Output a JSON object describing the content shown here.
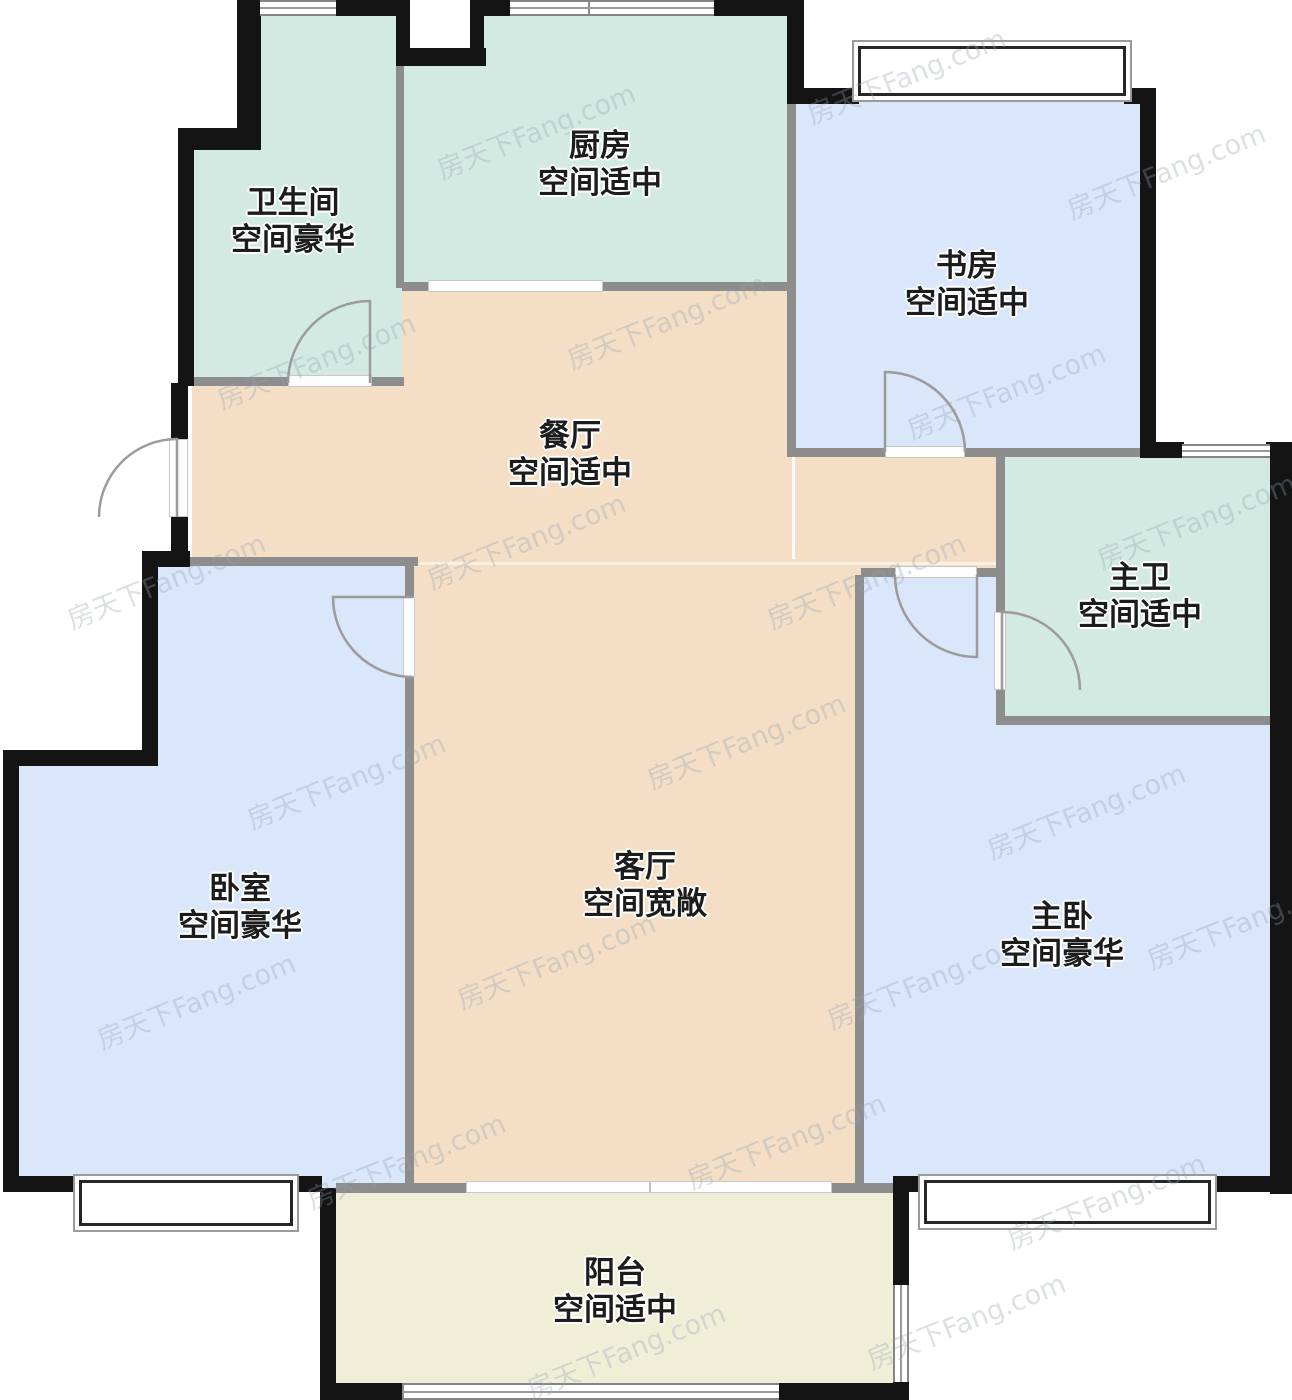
{
  "title": "户型图",
  "watermark": {
    "text": "房天下Fang.com"
  },
  "palette": {
    "mint": "#d3eae2",
    "blue": "#dae6f9",
    "peach": "#f4dfc6",
    "yellow": "#efefd8",
    "wall": "#141414",
    "partition": "#8d8d8d",
    "label": "#1c1c1c"
  },
  "rooms": [
    {
      "id": "bathroom",
      "name": "卫生间",
      "grade": "空间豪华"
    },
    {
      "id": "kitchen",
      "name": "厨房",
      "grade": "空间适中"
    },
    {
      "id": "study",
      "name": "书房",
      "grade": "空间适中"
    },
    {
      "id": "dining",
      "name": "餐厅",
      "grade": "空间适中"
    },
    {
      "id": "master-bath",
      "name": "主卫",
      "grade": "空间适中"
    },
    {
      "id": "bedroom",
      "name": "卧室",
      "grade": "空间豪华"
    },
    {
      "id": "living",
      "name": "客厅",
      "grade": "空间宽敞"
    },
    {
      "id": "master-bedroom",
      "name": "主卧",
      "grade": "空间豪华"
    },
    {
      "id": "balcony",
      "name": "阳台",
      "grade": "空间适中"
    }
  ]
}
